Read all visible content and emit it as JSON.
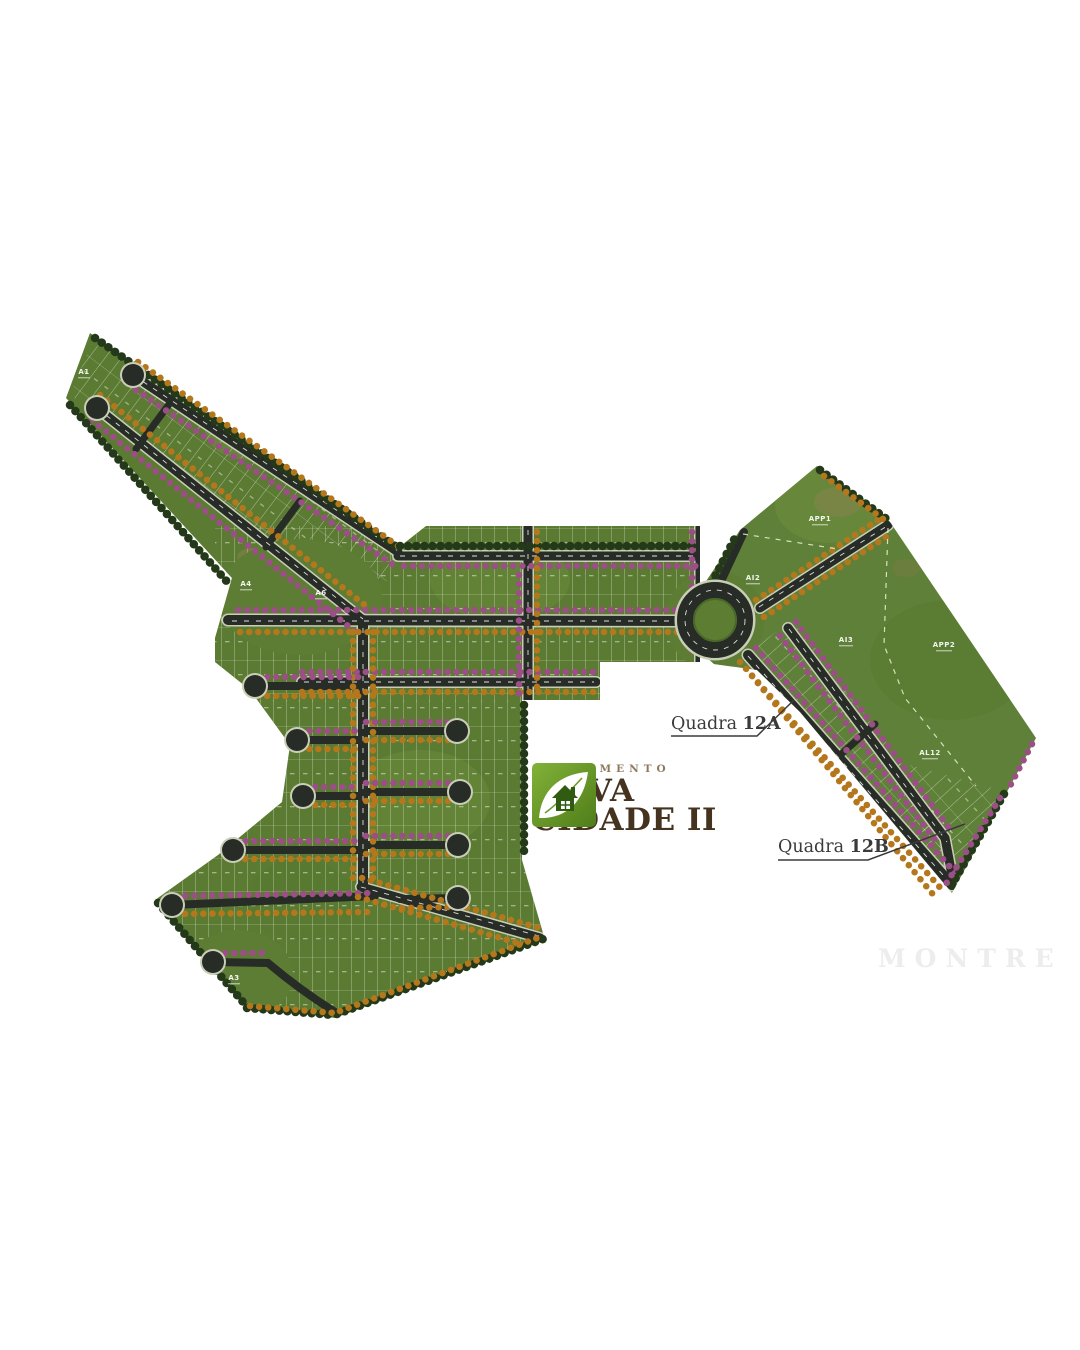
{
  "page": {
    "background": "#ffffff"
  },
  "logo": {
    "pretitle": "LOTEAMENTO",
    "title_line1": "NOVA",
    "title_line2": "CIDADE II"
  },
  "annotations": {
    "quadra_a_label": "Quadra",
    "quadra_a_number": "12A",
    "quadra_b_label": "Quadra",
    "quadra_b_number": "12B"
  },
  "area_labels": [
    "APP1",
    "AI2",
    "AI3",
    "APP2",
    "AL12",
    "AI13",
    "A4",
    "A6",
    "A3",
    "A1"
  ],
  "watermark": "MONTRE",
  "colors": {
    "grass": "#5b7a32",
    "grass_open": "#5f8038",
    "road": "#282c26",
    "sidewalk": "#c9cfb7",
    "tree_magenta": "#9c4f86",
    "tree_orange": "#b5771c",
    "tree_dark": "#23391a",
    "logo_green": "#6a9c28",
    "logo_text_brown": "#46331f",
    "annotation_gray": "#3a3a3a"
  }
}
